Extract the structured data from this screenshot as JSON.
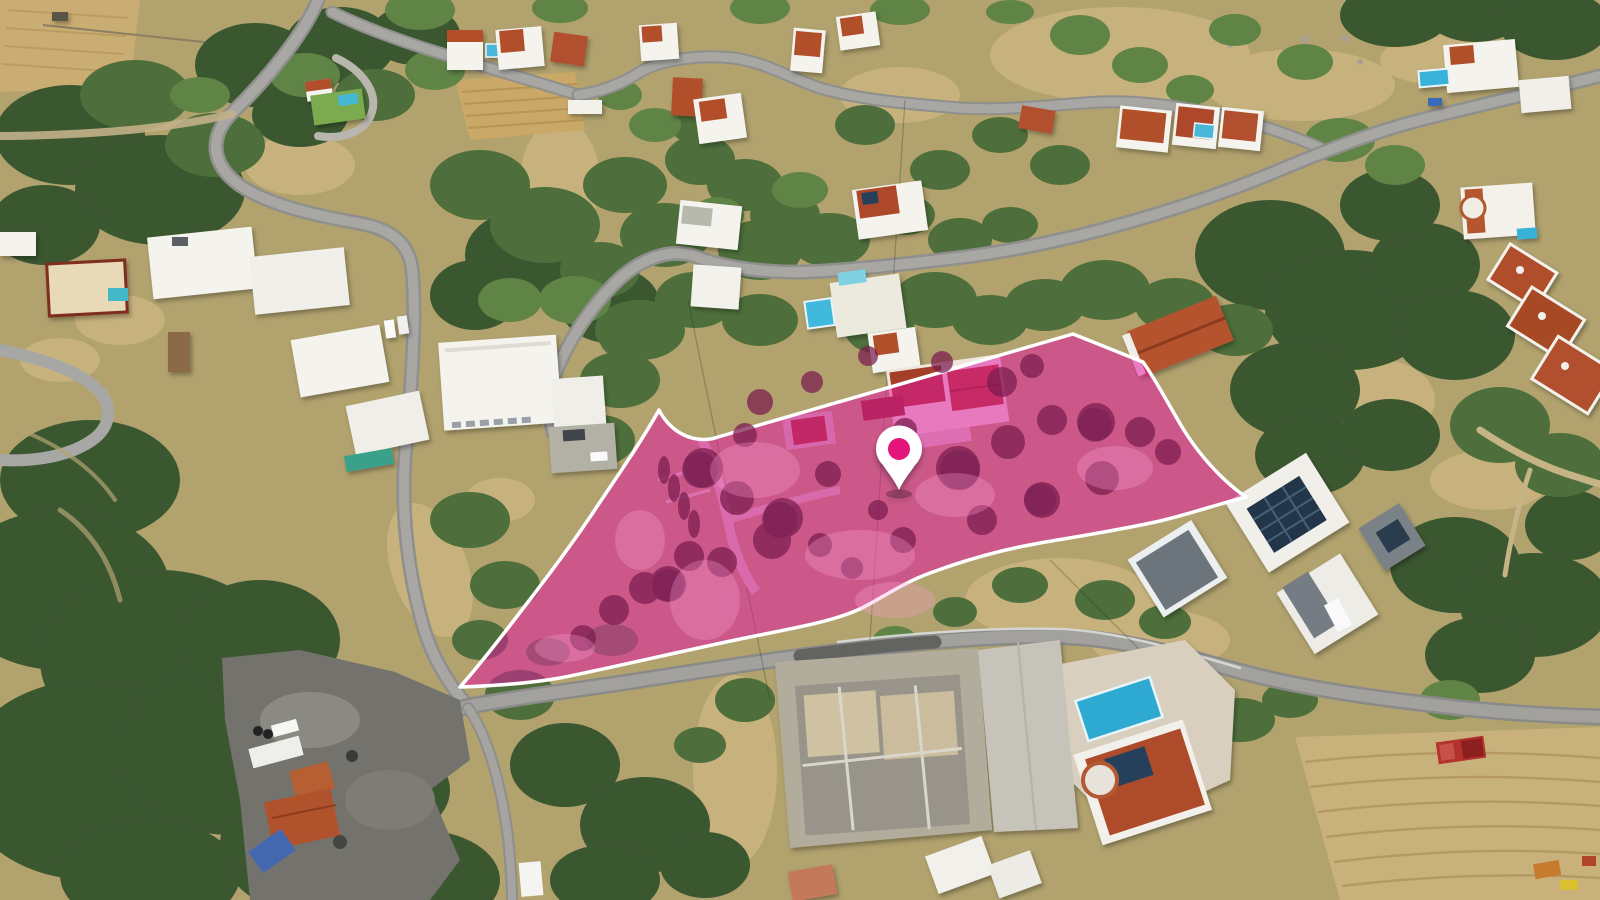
{
  "image": {
    "kind": "aerial-drone-photo",
    "subject": "hillside residential neighbourhood with highlighted land parcel for sale"
  },
  "parcel": {
    "path": "M 460 687 C 482 662 505 632 528 602 C 551 572 575 540 596 508 C 616 478 640 444 659 410 C 664 420 673 430 684 435 C 694 440 708 441 718 437 L 1073 334 L 1143 362 C 1156 380 1167 402 1182 427 C 1197 452 1221 480 1246 497 C 1215 505 1190 514 1160 521 C 1120 530 1080 536 1040 543 C 1000 550 965 560 930 573 C 905 582 885 596 862 608 C 835 621 795 628 755 636 C 690 649 620 666 560 678 C 525 684 490 686 460 687 Z",
    "fill": "#E316A2",
    "fill_opacity": 0.52,
    "outline": "#FFFFFF",
    "outline_width": 3.5
  },
  "marker": {
    "transform": "translate(899,450)",
    "pin_path": "M 0 40 C -5 29 -11 23 -16 15 A 23 23 0 1 1 16 15 C 11 23 5 29 0 40 Z",
    "body_fill": "#FFFFFF",
    "dot_fill": "#E4127B",
    "dot_radius": 11
  },
  "palette": {
    "highlight_magenta": "#E316A2",
    "pin_magenta": "#E4127B",
    "outline_white": "#FFFFFF",
    "pool_blue": "#35B0D6",
    "roof_terracotta": "#B14F2C",
    "vegetation_green": "#4E6F3B",
    "dry_field_tan": "#C7B27D",
    "road_gray": "#9A9A98"
  }
}
